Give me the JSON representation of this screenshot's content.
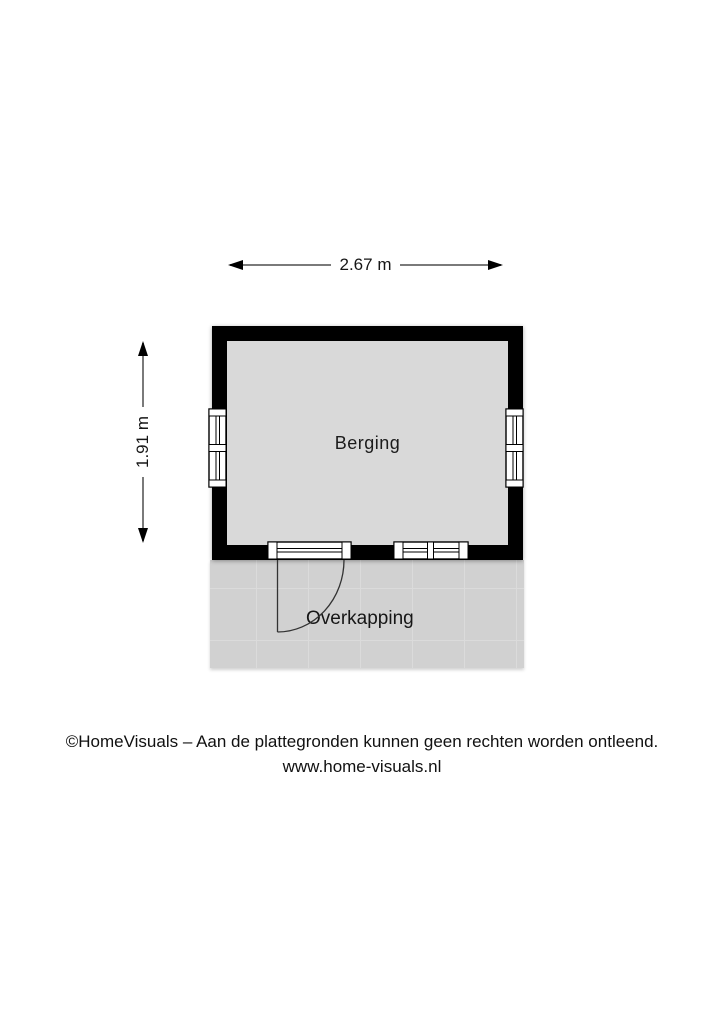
{
  "floorplan": {
    "room_label": "Berging",
    "area_label": "Overkapping",
    "dim_width_label": "2.67 m",
    "dim_height_label": "1.91 m"
  },
  "footer": {
    "line1": "©HomeVisuals – Aan de plattegronden kunnen geen rechten worden ontleend.",
    "line2": "www.home-visuals.nl"
  },
  "colors": {
    "wall": "#000000",
    "room_fill": "#d9d9d9",
    "paving_fill": "#d1d1d1",
    "dimension_line": "#7a7a7a"
  }
}
